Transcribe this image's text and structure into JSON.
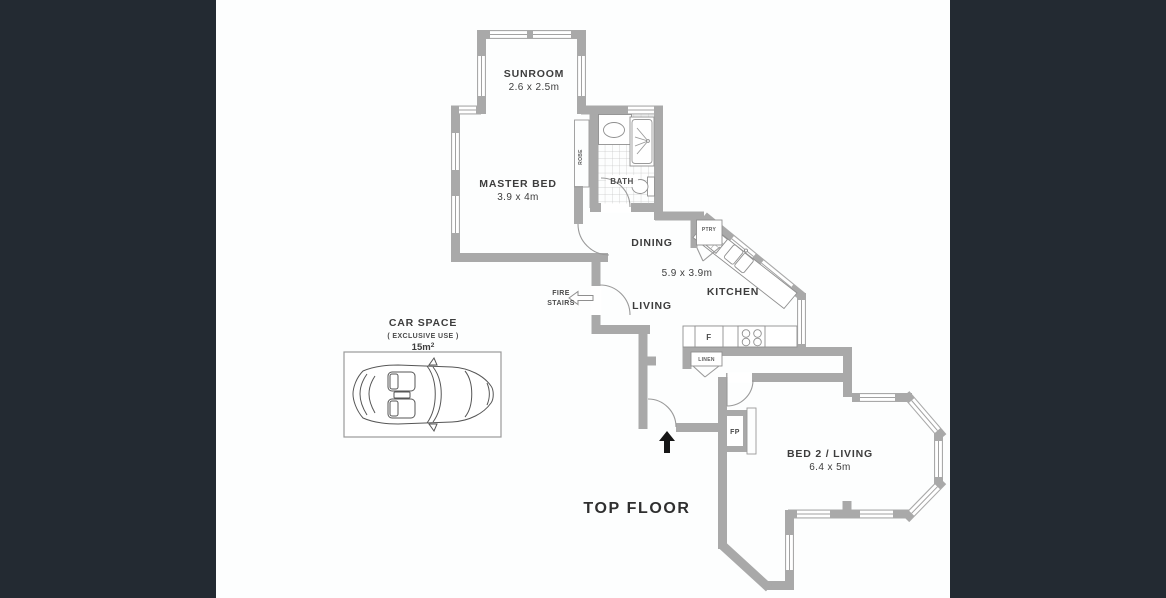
{
  "colors": {
    "sidebar": "#232a32",
    "wall": "#a9a9a9",
    "fixture_line": "#8f8f8f",
    "text": "#3d3d3d",
    "north_arrow": "#161616",
    "background": "#ffffff"
  },
  "plan": {
    "title": "TOP FLOOR",
    "rooms": {
      "sunroom": {
        "name": "SUNROOM",
        "dims": "2.6 x 2.5m"
      },
      "master_bed": {
        "name": "MASTER BED",
        "dims": "3.9 x 4m"
      },
      "bath": {
        "name": "BATH"
      },
      "robe": {
        "name": "ROBE"
      },
      "dining": {
        "name": "DINING"
      },
      "kitchen": {
        "name": "KITCHEN",
        "dims": "5.9 x 3.9m"
      },
      "living": {
        "name": "LIVING"
      },
      "bed2_living": {
        "name": "BED 2 / LIVING",
        "dims": "6.4 x 5m"
      },
      "fire_stairs": {
        "line1": "FIRE",
        "line2": "STAIRS"
      }
    },
    "closets": {
      "pantry": "PTRY",
      "fridge": "F",
      "linen": "LINEN",
      "fireplace": "FP"
    },
    "car_space": {
      "name": "CAR SPACE",
      "subtitle": "( EXCLUSIVE USE )",
      "area_value": "15m",
      "area_sup": "2"
    }
  }
}
